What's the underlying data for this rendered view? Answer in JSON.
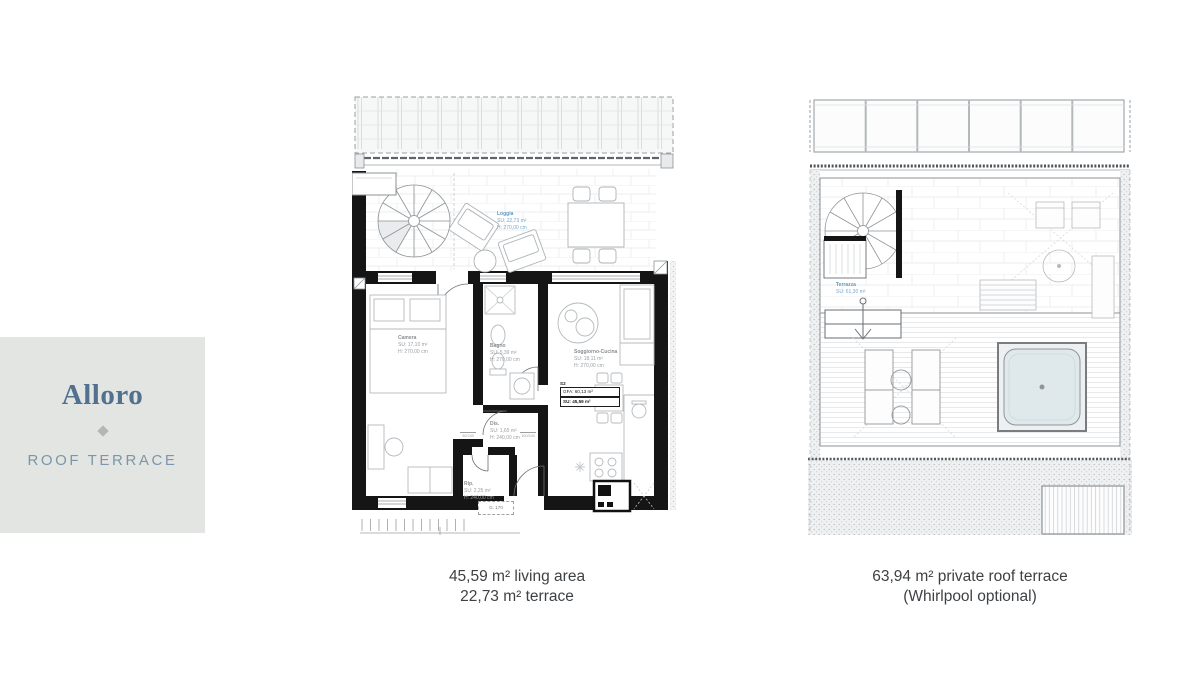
{
  "info_card": {
    "title": "Alloro",
    "subtitle": "ROOF TERRACE"
  },
  "floor_plan": {
    "caption_line1": "45,59 m² living area",
    "caption_line2": "22,73 m² terrace",
    "rooms": [
      {
        "name": "Loggia",
        "area": "SU: 22,73 m²",
        "height": "H: 270,00 cm"
      },
      {
        "name": "Camera",
        "area": "SU: 17,10 m²",
        "height": "H: 270,00 cm"
      },
      {
        "name": "Bagno",
        "area": "SU: 5,39 m²",
        "height": "H: 270,00 cm"
      },
      {
        "name": "Soggiorno-Cucina",
        "area": "SU: 18,11 m²",
        "height": "H: 270,00 cm"
      },
      {
        "name": "Dis.",
        "area": "SU: 1,65 m²",
        "height": "H: 240,00 cm"
      },
      {
        "name": "Rip.",
        "area": "SU: 2,25 m²",
        "height": "H: 240,00 cm"
      }
    ],
    "unit_box": {
      "id": "S2",
      "gfa": "GFA: 60,13 m²",
      "su": "SU: 45,59 m²"
    },
    "door_label": "G. 170",
    "dims": [
      "90/240",
      "100/240"
    ]
  },
  "roof_plan": {
    "caption_line1": "63,94 m² private roof terrace",
    "caption_line2": "(Whirlpool optional)",
    "label": {
      "name": "Terrazza",
      "area": "SU: 61,30 m²"
    }
  },
  "colors": {
    "card_bg": "#e3e5e3",
    "title": "#52718e",
    "subtitle": "#7b96a9",
    "caption_text": "#3e4144",
    "label_blue": "#5e9bc4",
    "wall": "#151515",
    "whirlpool": "#dfe9ec"
  }
}
